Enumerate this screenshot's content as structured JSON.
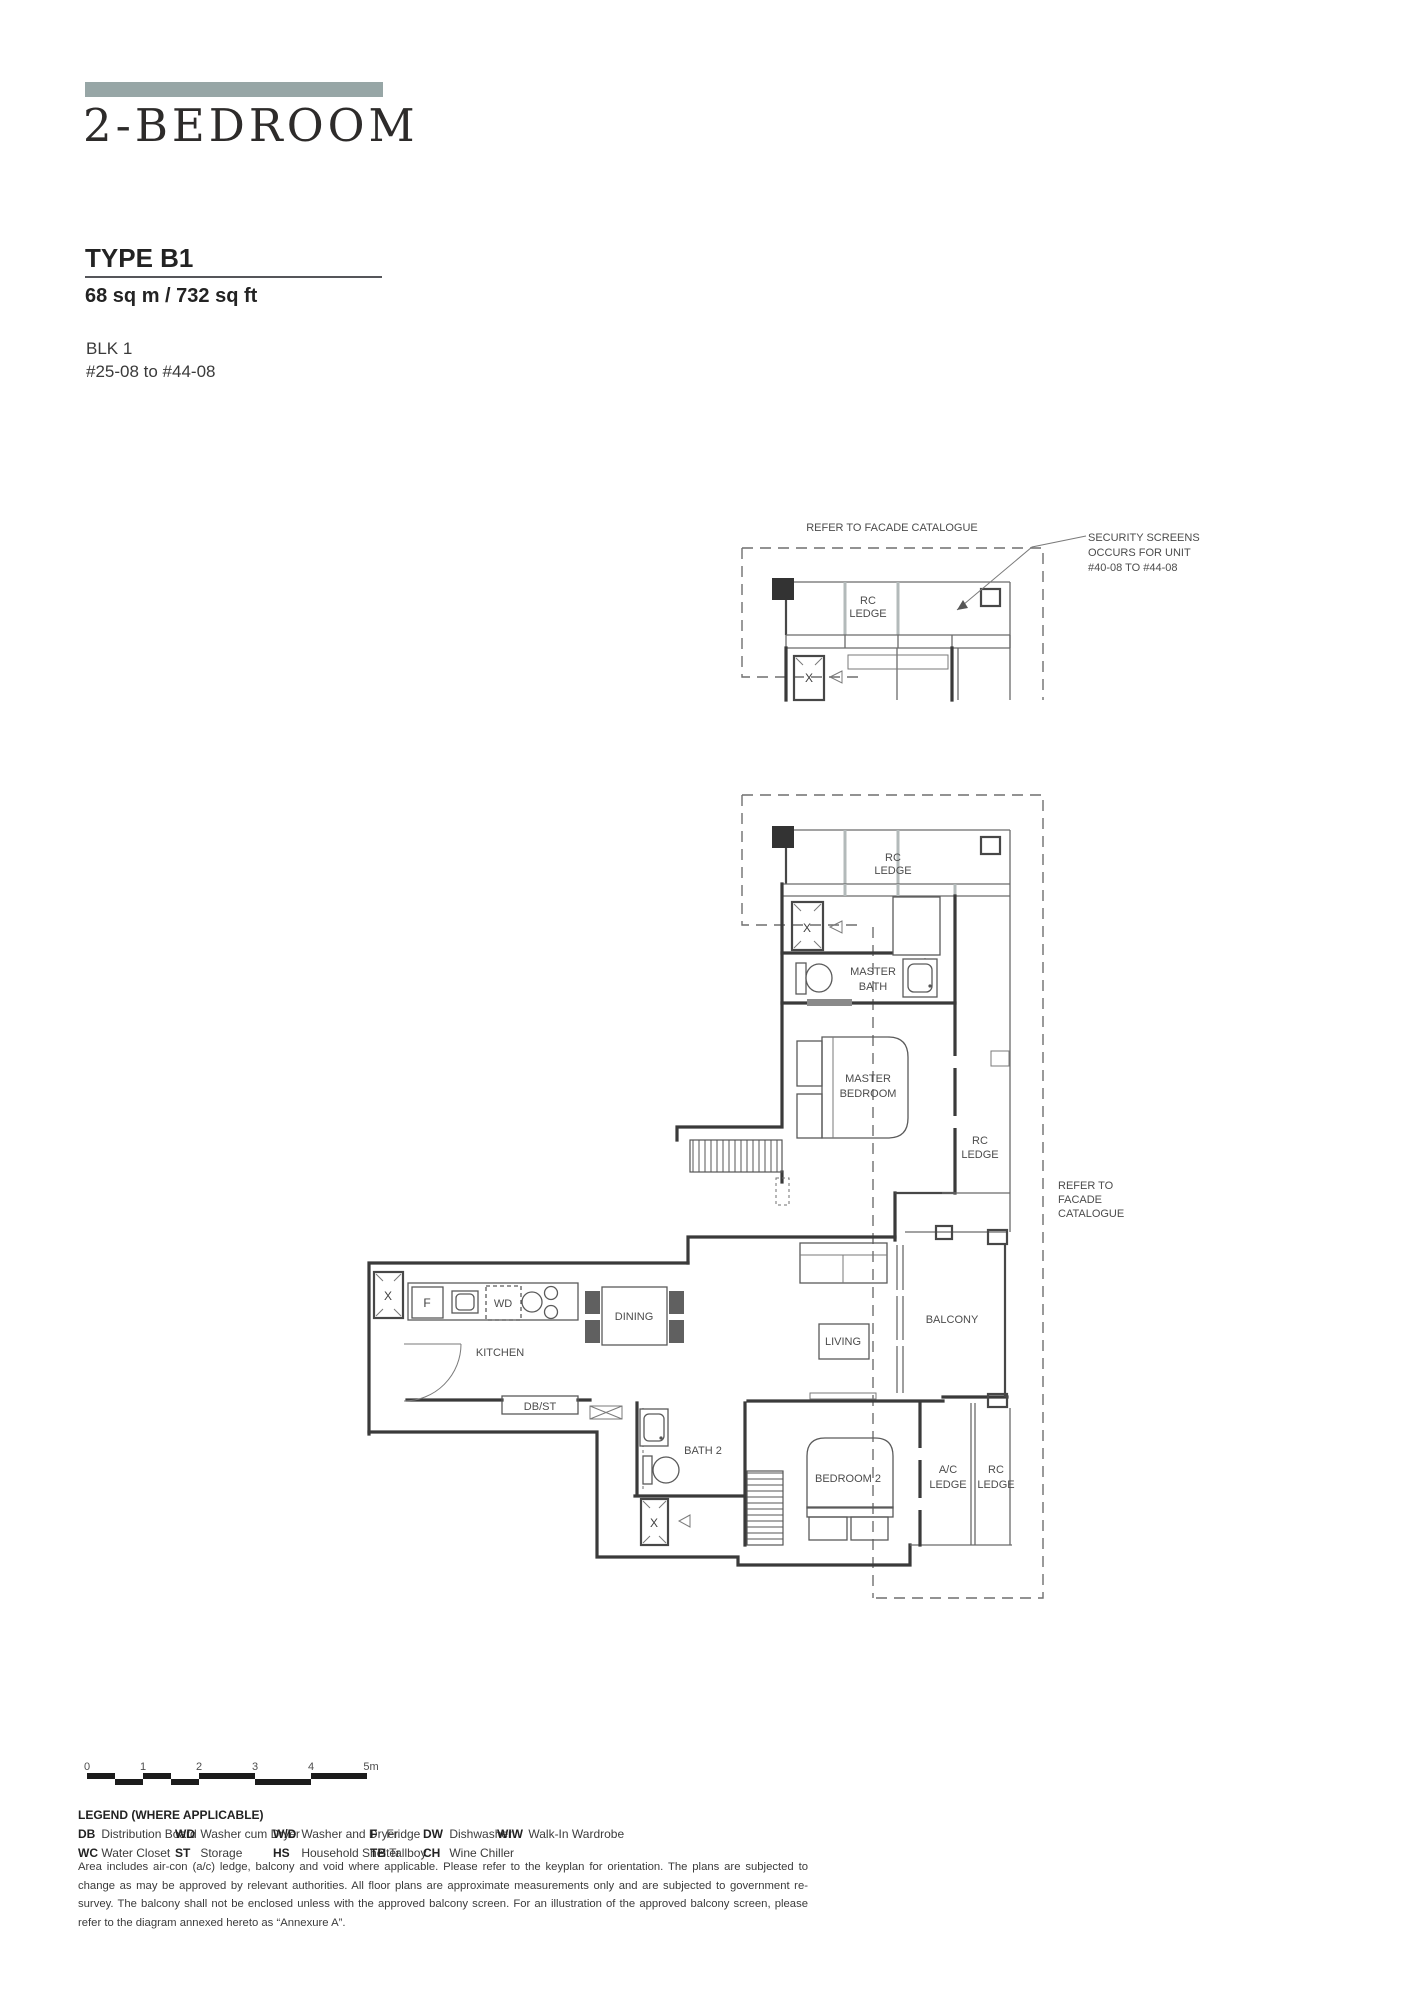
{
  "colors": {
    "accent_bar": "#97a6a6",
    "text": "#2a2a2a",
    "plan_line": "#3a3a3a"
  },
  "header": {
    "title": "2-BEDROOM",
    "type": "TYPE B1",
    "area": "68 sq m / 732 sq ft",
    "block": "BLK 1",
    "units": "#25-08 to #44-08"
  },
  "plan": {
    "labels": {
      "refer_facade_top": "REFER TO FACADE CATALOGUE",
      "security_1": "SECURITY SCREENS",
      "security_2": "OCCURS FOR UNIT",
      "security_3": "#40-08 TO #44-08",
      "rc": "RC",
      "ledge": "LEDGE",
      "master": "MASTER",
      "bath": "BATH",
      "bedroom": "BEDROOM",
      "refer_to": "REFER TO",
      "facade": "FACADE",
      "catalogue": "CATALOGUE",
      "kitchen": "KITCHEN",
      "dining": "DINING",
      "db_st": "DB/ST",
      "living": "LIVING",
      "balcony": "BALCONY",
      "bath_2": "BATH 2",
      "bedroom_2": "BEDROOM 2",
      "ac": "A/C",
      "x": "X",
      "fridge": "F",
      "wd": "WD"
    }
  },
  "scale": {
    "ticks": [
      "0",
      "1",
      "2",
      "3",
      "4",
      "5m"
    ]
  },
  "legend": {
    "heading": "LEGEND (WHERE APPLICABLE)",
    "items": [
      {
        "abbr": "DB",
        "desc": "Distribution Board"
      },
      {
        "abbr": "WC",
        "desc": "Water Closet"
      },
      {
        "abbr": "WD",
        "desc": "Washer cum Dryer"
      },
      {
        "abbr": "ST",
        "desc": "Storage"
      },
      {
        "abbr": "W/D",
        "desc": "Washer and Dryer"
      },
      {
        "abbr": "HS",
        "desc": "Household Shelter"
      },
      {
        "abbr": "F",
        "desc": "Fridge"
      },
      {
        "abbr": "TB",
        "desc": "Tallboy"
      },
      {
        "abbr": "DW",
        "desc": "Dishwasher"
      },
      {
        "abbr": "CH",
        "desc": "Wine Chiller"
      },
      {
        "abbr": "WIW",
        "desc": "Walk-In Wardrobe"
      }
    ]
  },
  "disclaimer": "Area includes air-con (a/c) ledge, balcony and void where applicable. Please refer to the keyplan for orientation. The plans are subjected to change as may be approved by relevant authorities. All floor plans are approximate measurements only and are subjected to government re-survey. The balcony shall not be enclosed unless with the approved balcony screen. For an illustration of the approved balcony screen, please refer to the diagram annexed hereto as “Annexure A”."
}
